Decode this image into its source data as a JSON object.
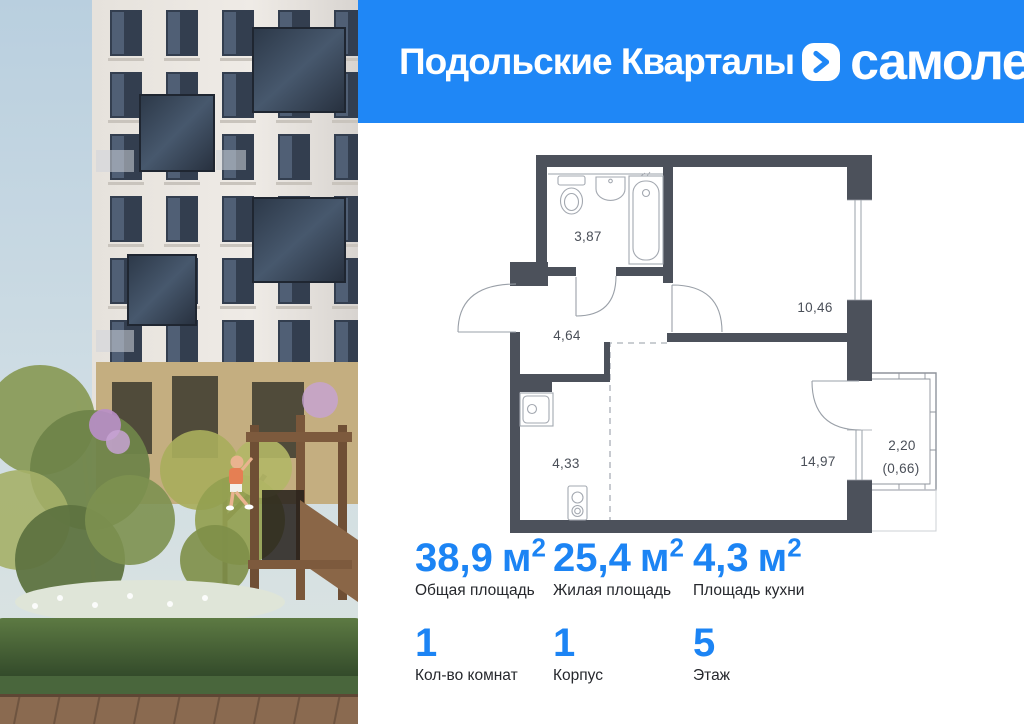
{
  "header": {
    "project_title": "Подольские Кварталы",
    "brand_name": "самолет",
    "bg_color": "#1f87f6"
  },
  "floor_plan": {
    "rooms": [
      {
        "name": "bathroom",
        "area": "3,87"
      },
      {
        "name": "hallway",
        "area": "4,64"
      },
      {
        "name": "bedroom",
        "area": "10,46"
      },
      {
        "name": "kitchen",
        "area": "4,33"
      },
      {
        "name": "living-room",
        "area": "14,97"
      },
      {
        "name": "balcony",
        "area": "2,20",
        "area_weighted": "(0,66)"
      }
    ],
    "wall_color": "#4c515b"
  },
  "stats": {
    "areas": [
      {
        "value": "38,9",
        "unit": "м",
        "unit_sup": "2",
        "label": "Общая площадь"
      },
      {
        "value": "25,4",
        "unit": "м",
        "unit_sup": "2",
        "label": "Жилая площадь"
      },
      {
        "value": "4,3",
        "unit": "м",
        "unit_sup": "2",
        "label": "Площадь кухни"
      }
    ],
    "details": [
      {
        "value": "1",
        "label": "Кол-во комнат"
      },
      {
        "value": "1",
        "label": "Корпус"
      },
      {
        "value": "5",
        "label": "Этаж"
      }
    ],
    "accent_color": "#1c84f4"
  }
}
